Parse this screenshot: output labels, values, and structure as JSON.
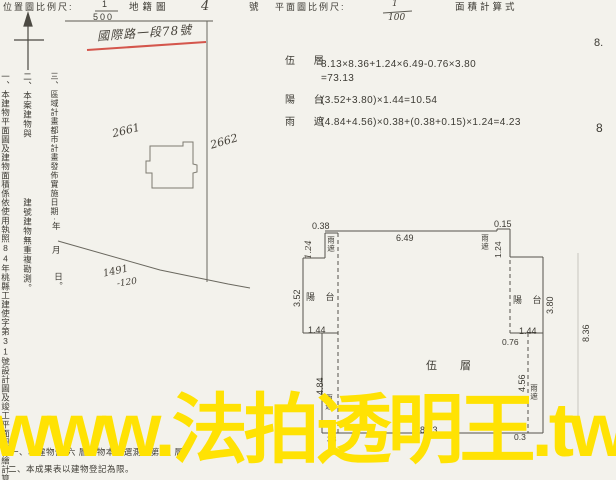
{
  "header": {
    "location_scale_label": "位置圖比例尺:",
    "location_scale_numerator": "1",
    "location_scale_denominator": "500",
    "cadastral_map_label": "地籍圖",
    "cadastral_map_number": "4",
    "number_suffix": "號",
    "plan_scale_label": "平面圖比例尺:",
    "plan_scale_numerator": "1",
    "plan_scale_denominator": "100",
    "area_formula_label": "面積計算式"
  },
  "stamp": {
    "text": "國際路一段78號",
    "underline_color": "#d0453b"
  },
  "location_map": {
    "parcel_left": "2661",
    "parcel_right": "2662",
    "parcel_bottom_a": "1491",
    "parcel_bottom_b": "-120"
  },
  "area_calc": {
    "row1_label": "伍 層",
    "row1_expr": "8.13×8.36+1.24×6.49-0.76×3.80",
    "row1_result": "=73.13",
    "row2_label": "陽 台",
    "row2_expr": "(3.52+3.80)×1.44=10.54",
    "row3_label": "雨 遮",
    "row3_expr": "(4.84+4.56)×0.38+(0.38+0.15)×1.24=4.23"
  },
  "side_notes": {
    "note1": "一、本建物平面圖及建物面積係依使用執照84年桃縣工建使字第31號設計圖及竣工平面圖轉繪計算。",
    "note2_prefix": "二、本案建物與",
    "note2_suffix": "建號建物無重複勘測。",
    "note3": "三、區域計畫都市計畫發佈實施日期:",
    "note3_year": "年",
    "note3_month": "月",
    "note3_day": "日。"
  },
  "floor_plan": {
    "room_label": "伍 層",
    "balcony_label": "陽 台",
    "eave_label": "雨遮",
    "dim_top_left": "0.38",
    "dim_top": "6.49",
    "dim_top_right": "0.15",
    "dim_eave_left_len": "1.24",
    "dim_eave_right_len": "1.24",
    "dim_balcony_left_h": "3.52",
    "dim_balcony_right_h": "3.80",
    "dim_balcony_left_w": "1.44",
    "dim_balcony_right_w": "1.44",
    "dim_inset": "0.76",
    "dim_left_side": "4.84",
    "dim_right_side": "4.56",
    "dim_overall_right": "8.36",
    "dim_bottom": "8.13",
    "dim_bottom_left": "38",
    "dim_bottom_right": "0.3"
  },
  "bottom_notes": {
    "line1": "一、本建物係 六 層建物本棟選測量第 五 層。",
    "line2": "二、本成果表以建物登記為限。"
  },
  "edge_fragments": {
    "top": "8.",
    "bottom": "8"
  },
  "watermark": {
    "text": "www.法拍透明王.tw",
    "color": "#ffe203"
  }
}
